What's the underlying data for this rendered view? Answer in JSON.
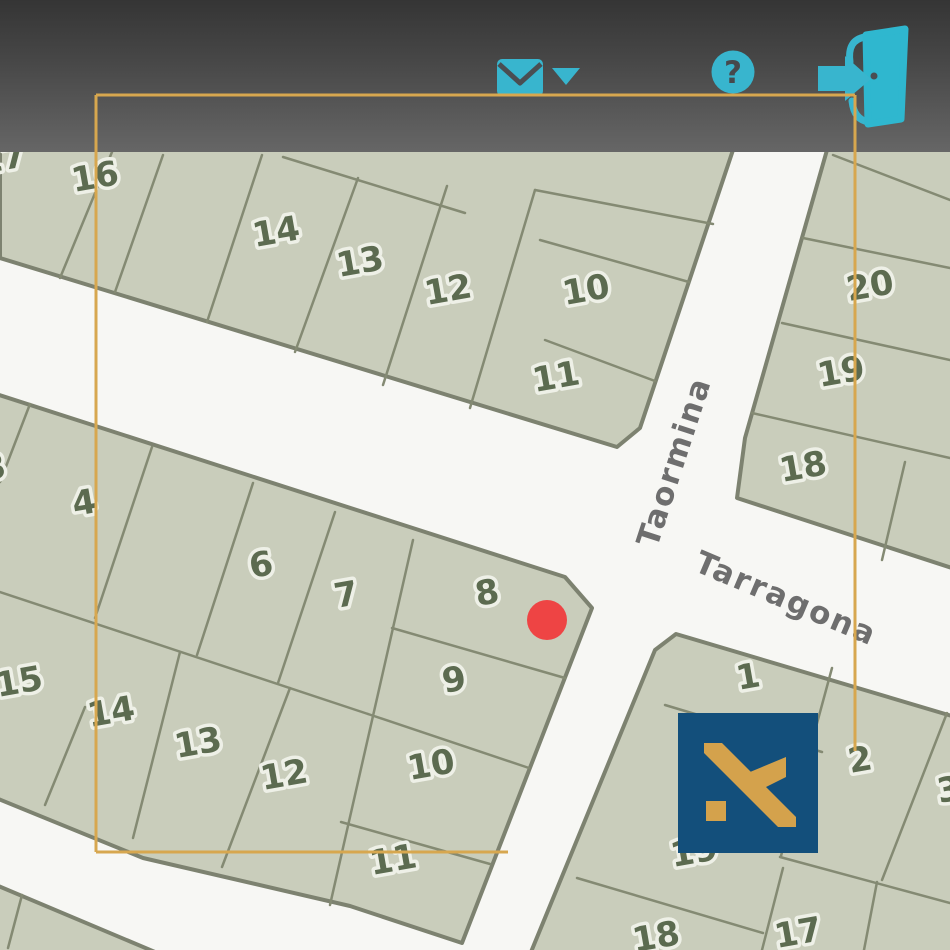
{
  "colors": {
    "teal_icon": "#38b5ce",
    "gold_frame": "#d7a74f",
    "logo_blue": "#134f7b",
    "logo_gold": "#d4a24c",
    "marker_red": "#ee4444",
    "street_white": "#f7f7f4",
    "parcel_fill": "#c9cdbb",
    "parcel_border": "#7d8270",
    "parcel_inner_border": "#848a73",
    "parcel_number": "#5c6b50",
    "parcel_number_halo": "#eef0e7",
    "street_label_gray": "#6e6e6e",
    "header_dark": "#3a3a3a"
  },
  "header": {
    "help_glyph": "?",
    "icons": [
      {
        "id": "messages",
        "glyph": "envelope-with-caret"
      },
      {
        "id": "help",
        "glyph": "question-mark-circle"
      },
      {
        "id": "logout",
        "glyph": "exit-door-arrow"
      }
    ]
  },
  "map": {
    "street_labels": [
      {
        "text": "Taormina",
        "x": 684,
        "y": 465,
        "rotate": -72
      },
      {
        "text": "Tarragona",
        "x": 782,
        "y": 608,
        "rotate": 23
      }
    ],
    "parcel_labels": [
      {
        "text": "17",
        "x": 4,
        "y": 170
      },
      {
        "text": "16",
        "x": 97,
        "y": 188
      },
      {
        "text": "14",
        "x": 278,
        "y": 243
      },
      {
        "text": "13",
        "x": 362,
        "y": 273
      },
      {
        "text": "12",
        "x": 450,
        "y": 301
      },
      {
        "text": "10",
        "x": 588,
        "y": 301
      },
      {
        "text": "11",
        "x": 558,
        "y": 388
      },
      {
        "text": "20",
        "x": 872,
        "y": 297
      },
      {
        "text": "19",
        "x": 843,
        "y": 383
      },
      {
        "text": "18",
        "x": 805,
        "y": 478
      },
      {
        "text": "3",
        "x": -4,
        "y": 479
      },
      {
        "text": "4",
        "x": 86,
        "y": 514
      },
      {
        "text": "6",
        "x": 263,
        "y": 576
      },
      {
        "text": "7",
        "x": 348,
        "y": 606
      },
      {
        "text": "8",
        "x": 489,
        "y": 604
      },
      {
        "text": "9",
        "x": 456,
        "y": 691
      },
      {
        "text": "15",
        "x": 21,
        "y": 693
      },
      {
        "text": "14",
        "x": 113,
        "y": 723
      },
      {
        "text": "13",
        "x": 200,
        "y": 754
      },
      {
        "text": "12",
        "x": 286,
        "y": 786
      },
      {
        "text": "10",
        "x": 433,
        "y": 776
      },
      {
        "text": "11",
        "x": 395,
        "y": 871
      },
      {
        "text": "1",
        "x": 750,
        "y": 688
      },
      {
        "text": "2",
        "x": 862,
        "y": 771
      },
      {
        "text": "3",
        "x": 951,
        "y": 801
      },
      {
        "text": "19",
        "x": 696,
        "y": 863
      },
      {
        "text": "18",
        "x": 658,
        "y": 948
      },
      {
        "text": "17",
        "x": 800,
        "y": 944
      }
    ],
    "marker": {
      "parcel": "8",
      "x": 547,
      "y": 620,
      "radius": 20
    }
  }
}
